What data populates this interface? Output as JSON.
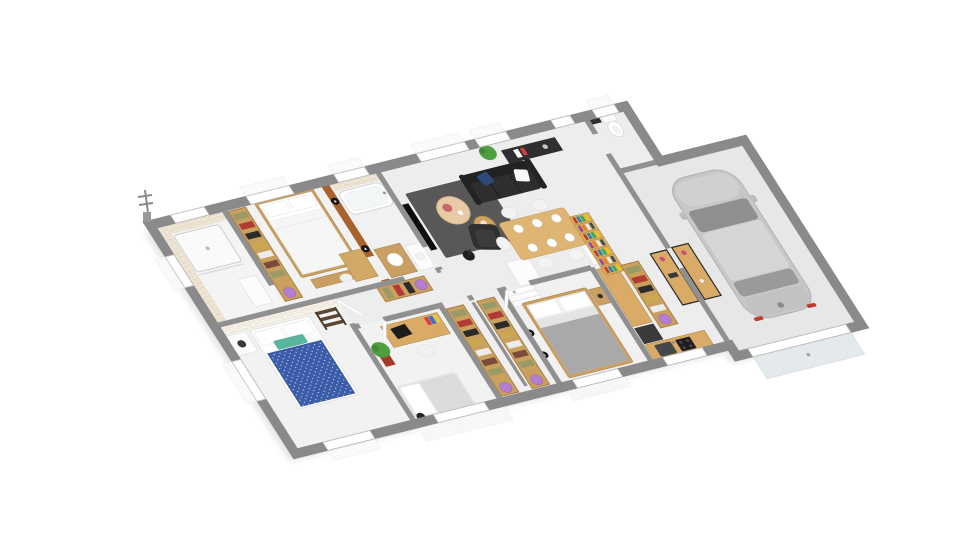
{
  "scene": {
    "type": "3d-isometric-floor-plan-rendering",
    "description": "Single-storey house 3D floor plan seen from above at an angle, white background, no text labels",
    "background": "#ffffff"
  },
  "palette": {
    "css": {
      "wall": "#909090",
      "wall-ext": "#8a8a8a",
      "floor": "#ededed",
      "floor-room": "#f2f2f2",
      "floor-garage": "#e7e7e7",
      "wood": "#cda263",
      "wood-dark": "#a87f44",
      "wood-light": "#ddb877",
      "sofa-black": "#2e2e2e",
      "rug-gray": "#585858",
      "teal-pillow": "#58b69e",
      "navy-duvet": "#3b5ca8",
      "accent-brown": "#a8622d",
      "tile-beige": "#e7dcc8",
      "car-gray": "#c7c7c7",
      "purple-bin": "#b57fd1",
      "taillight-red": "#c0392b",
      "garage-door": "#e4e9ec"
    }
  },
  "rooms": [
    {
      "name": "shower-room",
      "furniture": [
        "walk-in-shower",
        "beige-mosaic-tiled-walls",
        "window"
      ]
    },
    {
      "name": "bedroom-2",
      "furniture": [
        "double-bed-white-wood",
        "closet-rack",
        "foot-bench",
        "window"
      ]
    },
    {
      "name": "bathroom",
      "furniture": [
        "bathtub",
        "wood-vanity-sink",
        "washing-machine",
        "brown-accent-wall",
        "wall-lights",
        "window"
      ]
    },
    {
      "name": "bedroom-3",
      "furniture": [
        "double-bed-navy-teal",
        "white-brick-accent-wall",
        "nightstand-lamp",
        "ladder-shelf",
        "windows"
      ]
    },
    {
      "name": "hallway",
      "furniture": [
        "closet-rack"
      ]
    },
    {
      "name": "bedroom-1",
      "furniture": [
        "desk-laptop",
        "desk-chair",
        "single-bed-gray",
        "potted-plant",
        "window"
      ]
    },
    {
      "name": "dressing",
      "furniture": [
        "closet-rack",
        "closet-rack"
      ]
    },
    {
      "name": "master-bedroom",
      "furniture": [
        "double-bed-gray",
        "white-dresser",
        "nightstand-lamp",
        "wall-lights",
        "window"
      ]
    },
    {
      "name": "kitchen",
      "furniture": [
        "fridge-tall-white",
        "counter-along-wall",
        "front-counter",
        "sink",
        "cooktop",
        "dark-cabinet",
        "glass-door"
      ]
    },
    {
      "name": "cellier",
      "furniture": [
        "closet-rack",
        "console-table"
      ]
    },
    {
      "name": "living-dining",
      "furniture": [
        "black-sofa",
        "black-armchair",
        "tv-panel",
        "dark-rug",
        "round-coffee-table-large",
        "round-coffee-table-small",
        "floor-lamp",
        "dining-table",
        "six-chairs",
        "plates",
        "bookshelf",
        "tall-white-cabinet",
        "entry-console",
        "plant",
        "large-windows"
      ]
    },
    {
      "name": "wc",
      "furniture": [
        "toilet",
        "wall-shelf",
        "window"
      ]
    },
    {
      "name": "garage",
      "furniture": [
        "gray-hatchback-car",
        "sectional-garage-door",
        "console-table"
      ]
    }
  ],
  "closets": {
    "garment_colors": [
      "#9a9a66",
      "#b23b34",
      "#2b2b2b",
      "#c9a84f",
      "#ececec",
      "#7a4a3a"
    ],
    "rack_base": "#c9a05e",
    "bin_color": "#b57fd1",
    "racks": [
      {
        "x": 156,
        "y": 12,
        "len": 204,
        "dir": "v",
        "depth": 36
      },
      {
        "x": 336,
        "y": 234,
        "len": 98,
        "dir": "h",
        "depth": 32
      },
      {
        "x": 436,
        "y": 310,
        "len": 198,
        "dir": "v",
        "depth": 36
      },
      {
        "x": 500,
        "y": 310,
        "len": 198,
        "dir": "v",
        "depth": 36
      },
      {
        "x": 800,
        "y": 310,
        "len": 142,
        "dir": "v",
        "depth": 36
      }
    ]
  },
  "bookshelf": {
    "x": 762,
    "y": 190,
    "w": 40,
    "h": 132,
    "shelves": 7,
    "book_colors": [
      "#c0392b",
      "#2980b9",
      "#27ae60",
      "#f1c40f",
      "#8e44ad",
      "#e67e22",
      "#ecf0f1",
      "#34495e"
    ]
  },
  "wall_lights": [
    {
      "x": 360,
      "y": 44
    },
    {
      "x": 360,
      "y": 152
    },
    {
      "x": 560,
      "y": 398
    },
    {
      "x": 560,
      "y": 448
    }
  ]
}
